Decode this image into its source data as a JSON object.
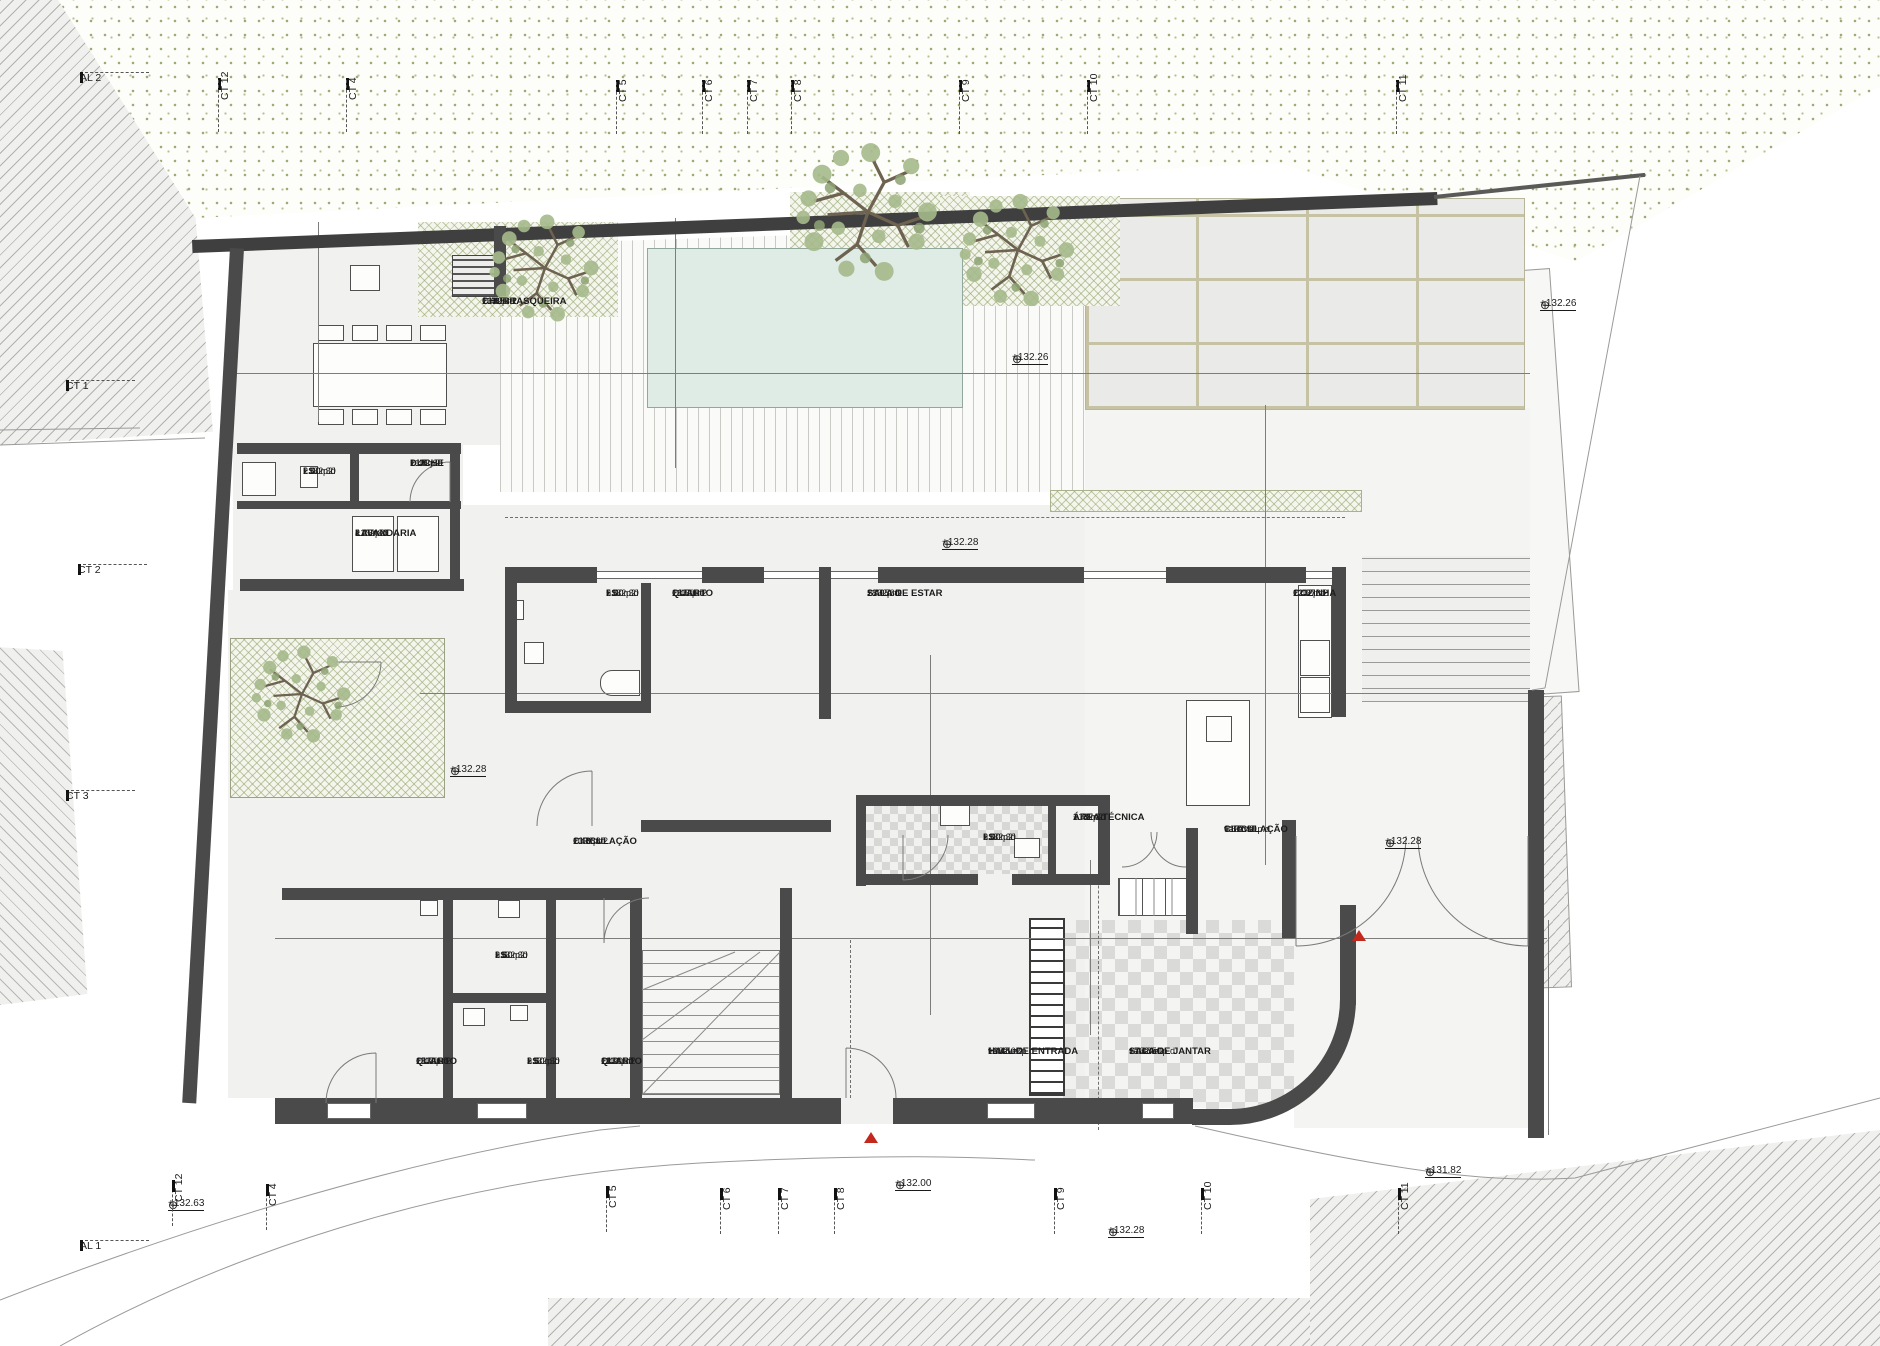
{
  "drawing": {
    "type": "architectural floor plan",
    "entrance_note": "ENTRADA PRINCIPAL",
    "slope_note": "i 4%",
    "curve_radius": "R2.55"
  },
  "colors": {
    "wall": "#4a4a4a",
    "pool_water": "#dfece6",
    "vegetation": "#9dac76",
    "paver_joint": "#c6c2a4",
    "marker_red": "#c4271b"
  },
  "rooms": [
    {
      "name": "CHURRASQUEIRA",
      "area": "16.85m2",
      "pd": "2.40  p.d",
      "elev": "+132.30",
      "x": 482,
      "y": 296
    },
    {
      "name": "I.S.",
      "area": "2.00m2",
      "pd": "2.40  p.d",
      "elev": "+132.30",
      "x": 303,
      "y": 466
    },
    {
      "name": "DUCHE",
      "area": "1.45m2",
      "pd": "2.40  p.d",
      "elev": "+132.30",
      "x": 410,
      "y": 458
    },
    {
      "name": "LAVANDARIA",
      "area": "4.25m2",
      "pd": "2.40  p.d",
      "elev": "+132.30",
      "x": 355,
      "y": 528
    },
    {
      "name": "I.S.",
      "area": "5.00m2",
      "pd": "2.40  p.d",
      "elev": "+132.30",
      "x": 606,
      "y": 588
    },
    {
      "name": "QUARTO",
      "area": "16.50m2",
      "pd": "2.40  p.d",
      "elev": "+132.30",
      "x": 672,
      "y": 588
    },
    {
      "name": "SALA DE ESTAR",
      "area": "28.95m2",
      "pd": "2.40  p.d",
      "elev": "+132.30",
      "x": 867,
      "y": 588
    },
    {
      "name": "COZINHA",
      "area": "12.37m2",
      "pd": "2.40  p.d",
      "elev": "+132.30",
      "x": 1293,
      "y": 588
    },
    {
      "name": "CIRCULAÇÃO",
      "area": "10.38m2",
      "pd": "2.40  p.d",
      "elev": "+132.30",
      "x": 573,
      "y": 836
    },
    {
      "name": "I.S.",
      "area": "3.00m2",
      "pd": "2.40  p.d",
      "elev": "+132.30",
      "x": 983,
      "y": 832
    },
    {
      "name": "ÁREA TÉCNICA",
      "area": "1.43m2",
      "pd": "2.40  p.d",
      "elev": "+132.30",
      "x": 1073,
      "y": 812
    },
    {
      "name": "CIRCULAÇÃO",
      "area": "9.67m2",
      "pd": "variável  p.d",
      "elev": "+132.30",
      "x": 1224,
      "y": 824
    },
    {
      "name": "QUARTO",
      "area": "15.70m2",
      "pd": "2.40  p.d",
      "elev": "+132.30",
      "x": 416,
      "y": 1056
    },
    {
      "name": "I.S.",
      "area": "3.50m2",
      "pd": "2.40  p.d",
      "elev": "+132.30",
      "x": 495,
      "y": 950
    },
    {
      "name": "I.S.",
      "area": "3.50m2",
      "pd": "2.40  p.d",
      "elev": "+132.30",
      "x": 527,
      "y": 1056
    },
    {
      "name": "QUARTO",
      "area": "11.90m2",
      "pd": "2.40  p.d",
      "elev": "+132.30",
      "x": 601,
      "y": 1056
    },
    {
      "name": "HALL DE ENTRADA",
      "area": "16.45m2",
      "pd": "variável  p.d",
      "elev": "+132.02",
      "x": 988,
      "y": 1046
    },
    {
      "name": "SALA DE JANTAR",
      "area": "17.43m2",
      "pd": "variável  p.d",
      "elev": "+132.50",
      "x": 1129,
      "y": 1046
    }
  ],
  "dims": [
    {
      "t": "0.20",
      "x": 258,
      "y": 390
    },
    {
      "t": "5.00",
      "x": 378,
      "y": 362
    },
    {
      "t": "2.62",
      "x": 577,
      "y": 362
    },
    {
      "t": "6.00",
      "x": 798,
      "y": 362
    },
    {
      "t": "2.66",
      "x": 1023,
      "y": 366
    },
    {
      "t": "8.24",
      "x": 1313,
      "y": 366
    },
    {
      "t": "0.66",
      "x": 311,
      "y": 272,
      "r": -90
    },
    {
      "t": "0.20",
      "x": 328,
      "y": 268,
      "r": -90
    },
    {
      "t": "2.84",
      "x": 311,
      "y": 365,
      "r": -90
    },
    {
      "t": "0.15",
      "x": 662,
      "y": 234,
      "r": -90
    },
    {
      "t": "3.00",
      "x": 671,
      "y": 322,
      "r": -90
    },
    {
      "t": "2.00",
      "x": 671,
      "y": 455,
      "r": -90
    },
    {
      "t": "5.36",
      "x": 1262,
      "y": 345,
      "r": -90
    },
    {
      "t": "0.33",
      "x": 1271,
      "y": 472,
      "r": -90
    },
    {
      "t": "2.00",
      "x": 306,
      "y": 460
    },
    {
      "t": "1.50",
      "x": 408,
      "y": 460
    },
    {
      "t": "3.55",
      "x": 355,
      "y": 520
    },
    {
      "t": "0.15",
      "x": 327,
      "y": 520,
      "r": -90
    },
    {
      "t": "1.20",
      "x": 306,
      "y": 547,
      "r": -90
    },
    {
      "t": "0.15",
      "x": 327,
      "y": 566,
      "r": -90
    },
    {
      "t": "1.10",
      "x": 462,
      "y": 687
    },
    {
      "t": "0.35",
      "x": 500,
      "y": 687,
      "r": -90
    },
    {
      "t": "0.60",
      "x": 534,
      "y": 687
    },
    {
      "t": "1.67",
      "x": 585,
      "y": 687
    },
    {
      "t": "3.39",
      "x": 740,
      "y": 687
    },
    {
      "t": "10.31",
      "x": 908,
      "y": 687
    },
    {
      "t": "4.05",
      "x": 928,
      "y": 676,
      "r": -90
    },
    {
      "t": "3.45",
      "x": 670,
      "y": 658,
      "r": -90
    },
    {
      "t": "1.10",
      "x": 673,
      "y": 528,
      "r": -90
    },
    {
      "t": "0.35",
      "x": 690,
      "y": 592,
      "r": -90
    },
    {
      "t": "1.20",
      "x": 1213,
      "y": 687
    },
    {
      "t": "1.20",
      "x": 1277,
      "y": 687
    },
    {
      "t": "0.60",
      "x": 1342,
      "y": 687
    },
    {
      "t": "0.35",
      "x": 1374,
      "y": 690,
      "r": -90
    },
    {
      "t": "3.37",
      "x": 1452,
      "y": 687
    },
    {
      "t": "0.15",
      "x": 1528,
      "y": 700,
      "r": -90
    },
    {
      "t": "1.10",
      "x": 1262,
      "y": 528,
      "r": -90
    },
    {
      "t": "0.35",
      "x": 1277,
      "y": 550,
      "r": -90
    },
    {
      "t": "1.00",
      "x": 1262,
      "y": 607,
      "r": -90
    },
    {
      "t": "3.20",
      "x": 1260,
      "y": 722,
      "r": -90
    },
    {
      "t": "1.50",
      "x": 1260,
      "y": 842,
      "r": -90
    },
    {
      "t": "0.60",
      "x": 676,
      "y": 783,
      "r": -90
    },
    {
      "t": "0.55",
      "x": 676,
      "y": 813,
      "r": -90
    },
    {
      "t": "1.20",
      "x": 674,
      "y": 858,
      "r": -90
    },
    {
      "t": "0.15",
      "x": 948,
      "y": 786,
      "r": -90
    },
    {
      "t": "1.25",
      "x": 928,
      "y": 840,
      "r": -90
    },
    {
      "t": "0.20",
      "x": 300,
      "y": 952
    },
    {
      "t": "2.80",
      "x": 362,
      "y": 931
    },
    {
      "t": "0.55",
      "x": 450,
      "y": 931
    },
    {
      "t": "1.91",
      "x": 522,
      "y": 931
    },
    {
      "t": "0.15",
      "x": 484,
      "y": 952
    },
    {
      "t": "0.15",
      "x": 593,
      "y": 952
    },
    {
      "t": "2.80",
      "x": 650,
      "y": 931
    },
    {
      "t": "0.75",
      "x": 714,
      "y": 931
    },
    {
      "t": "4.98",
      "x": 897,
      "y": 931
    },
    {
      "t": "0.80",
      "x": 1048,
      "y": 931
    },
    {
      "t": "5.22",
      "x": 1206,
      "y": 931
    },
    {
      "t": "0.35",
      "x": 1286,
      "y": 950
    },
    {
      "t": "3.47",
      "x": 1447,
      "y": 929
    },
    {
      "t": "0.14",
      "x": 1530,
      "y": 950
    },
    {
      "t": "5.21",
      "x": 307,
      "y": 972,
      "r": -90
    },
    {
      "t": "3.85",
      "x": 657,
      "y": 992,
      "r": -90
    },
    {
      "t": "4.14",
      "x": 942,
      "y": 992,
      "r": -90
    },
    {
      "t": "3.54",
      "x": 1088,
      "y": 1014,
      "r": -90
    },
    {
      "t": "0.70",
      "x": 1086,
      "y": 890,
      "r": -90
    },
    {
      "t": "0.15",
      "x": 1101,
      "y": 890,
      "r": -90
    },
    {
      "t": "0.15",
      "x": 1101,
      "y": 934,
      "r": -90
    },
    {
      "t": "0.35",
      "x": 1097,
      "y": 1092,
      "r": -90
    },
    {
      "t": "3.30",
      "x": 1556,
      "y": 1036,
      "r": -90
    },
    {
      "t": "0.15",
      "x": 948,
      "y": 892,
      "r": -90
    }
  ],
  "levels": [
    {
      "v": "+132.26",
      "x": 1012,
      "y": 352
    },
    {
      "v": "+132.26",
      "x": 1540,
      "y": 298
    },
    {
      "v": "+132.28",
      "x": 942,
      "y": 537
    },
    {
      "v": "+132.28",
      "x": 450,
      "y": 764
    },
    {
      "v": "+132.28",
      "x": 1385,
      "y": 836
    },
    {
      "v": "+132.28",
      "x": 1108,
      "y": 1225
    },
    {
      "v": "+132.00",
      "x": 895,
      "y": 1178
    },
    {
      "v": "+131.82",
      "x": 1425,
      "y": 1165
    },
    {
      "v": "+132.63",
      "x": 168,
      "y": 1198
    }
  ],
  "texts": [
    {
      "t": "ENTRADA  PRINCIPAL",
      "x": 874,
      "y": 1152,
      "cls": "big"
    },
    {
      "t": "i  4%",
      "x": 1440,
      "y": 1092,
      "cls": "med"
    },
    {
      "t": "FR",
      "x": 1316,
      "y": 592
    },
    {
      "t": "MILL",
      "x": 1314,
      "y": 655
    },
    {
      "t": "R2.55",
      "x": 1312,
      "y": 1082,
      "r": 45
    },
    {
      "t": "05",
      "x": 718,
      "y": 1050
    },
    {
      "t": "04",
      "x": 718,
      "y": 1086
    },
    {
      "t": "03",
      "x": 746,
      "y": 1086
    },
    {
      "t": "02",
      "x": 761,
      "y": 1086
    },
    {
      "t": "01",
      "x": 775,
      "y": 1086
    },
    {
      "t": "02",
      "x": 772,
      "y": 876
    },
    {
      "t": "01",
      "x": 772,
      "y": 896
    },
    {
      "t": "03",
      "x": 895,
      "y": 824
    },
    {
      "t": "04",
      "x": 918,
      "y": 824
    },
    {
      "t": "02",
      "x": 1189,
      "y": 862
    },
    {
      "t": "01",
      "x": 1168,
      "y": 880
    },
    {
      "t": "03",
      "x": 1191,
      "y": 880
    },
    {
      "t": "04",
      "x": 1191,
      "y": 920
    }
  ],
  "grid": {
    "top": [
      {
        "label": "CT 12",
        "x": 218,
        "y": 78
      },
      {
        "label": "CT 4",
        "x": 346,
        "y": 78
      },
      {
        "label": "CT 5",
        "x": 616,
        "y": 80
      },
      {
        "label": "CT 6",
        "x": 702,
        "y": 80
      },
      {
        "label": "CT 7",
        "x": 747,
        "y": 80
      },
      {
        "label": "CT 8",
        "x": 791,
        "y": 80
      },
      {
        "label": "CT 9",
        "x": 959,
        "y": 80
      },
      {
        "label": "CT 10",
        "x": 1087,
        "y": 80
      },
      {
        "label": "CT 11",
        "x": 1396,
        "y": 80
      }
    ],
    "bottom": [
      {
        "label": "CT 12",
        "x": 172,
        "y": 1180
      },
      {
        "label": "CT 4",
        "x": 266,
        "y": 1184
      },
      {
        "label": "CT 5",
        "x": 606,
        "y": 1186
      },
      {
        "label": "CT 6",
        "x": 720,
        "y": 1188
      },
      {
        "label": "CT 7",
        "x": 778,
        "y": 1188
      },
      {
        "label": "CT 8",
        "x": 834,
        "y": 1188
      },
      {
        "label": "CT 9",
        "x": 1054,
        "y": 1188
      },
      {
        "label": "CT 10",
        "x": 1201,
        "y": 1188
      },
      {
        "label": "CT 11",
        "x": 1398,
        "y": 1188
      }
    ],
    "side": [
      {
        "label": "AL 2",
        "x": 80,
        "y": 72
      },
      {
        "label": "CT 1",
        "x": 66,
        "y": 380
      },
      {
        "label": "CT 2",
        "x": 78,
        "y": 564
      },
      {
        "label": "CT 3",
        "x": 66,
        "y": 790
      },
      {
        "label": "AL 1",
        "x": 80,
        "y": 1240
      }
    ]
  }
}
